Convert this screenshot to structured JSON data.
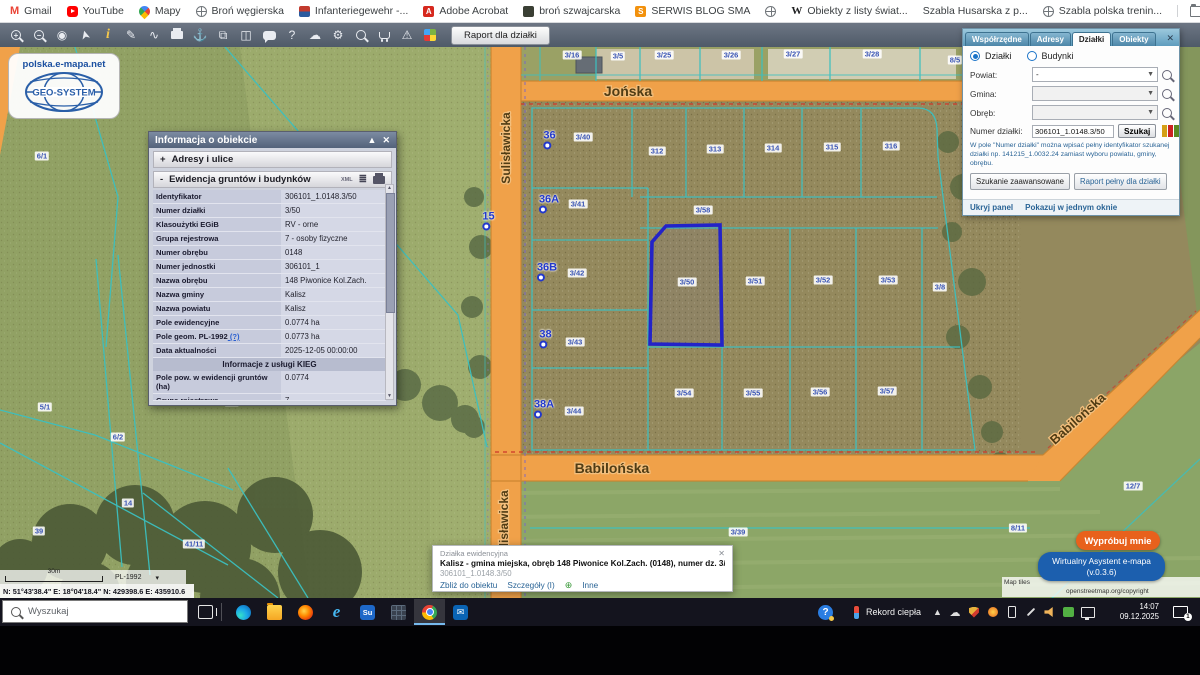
{
  "colors": {
    "road_orange": "#f0a149",
    "selection_blue": "#2323c8",
    "boundary_teal": "#3cc0c0",
    "parcel_label_blue": "#3a55b5",
    "assistant_orange": "#e8611c",
    "assistant_blue": "#1c5fae"
  },
  "bookmarks_bar": {
    "items": [
      {
        "icon": "gmail",
        "label": "Gmail"
      },
      {
        "icon": "youtube",
        "label": "YouTube"
      },
      {
        "icon": "maps-pin",
        "label": "Mapy"
      },
      {
        "icon": "globe",
        "label": "Broń węgierska"
      },
      {
        "icon": "flag",
        "label": "Infanteriegewehr -..."
      },
      {
        "icon": "acrobat",
        "label": "Adobe Acrobat"
      },
      {
        "icon": "dark-app",
        "label": "broń szwajcarska"
      },
      {
        "icon": "blog",
        "label": "SERWIS BLOG SMA"
      },
      {
        "icon": "globe",
        "label": ""
      },
      {
        "icon": "wikipedia",
        "label": "Obiekty z listy świat..."
      },
      {
        "icon": "none",
        "label": "Szabla Husarska z p..."
      },
      {
        "icon": "globe",
        "label": "Szabla polska trenin..."
      }
    ],
    "all_bookmarks": "Wszystkie zakładki"
  },
  "toolbar": {
    "tools": [
      {
        "name": "zoom-in"
      },
      {
        "name": "zoom-out"
      },
      {
        "name": "select-area"
      },
      {
        "name": "pointer"
      },
      {
        "name": "object-info"
      },
      {
        "name": "measure"
      },
      {
        "name": "link"
      },
      {
        "name": "print"
      },
      {
        "name": "download"
      },
      {
        "name": "copy-view"
      },
      {
        "name": "layout"
      },
      {
        "name": "comment"
      },
      {
        "name": "help"
      },
      {
        "name": "cloud-upload"
      },
      {
        "name": "settings"
      },
      {
        "name": "search-advanced"
      },
      {
        "name": "cart"
      },
      {
        "name": "warnings"
      },
      {
        "name": "legend"
      }
    ],
    "report_button": "Raport dla działki"
  },
  "map": {
    "logo": {
      "url_text": "polska.e-mapa.net",
      "brand": "GEO-SYSTEM"
    },
    "streets": {
      "jonska": "Jońska",
      "babilonska": "Babilońska",
      "babilonska_diag": "Babilońska",
      "sulislawicka": "Sulisławicka",
      "sulislawicka2": "Sulisławicka"
    },
    "selected_parcel": "3/50",
    "parcel_labels": [
      {
        "t": "3/16",
        "x": 572,
        "y": 8
      },
      {
        "t": "3/5",
        "x": 618,
        "y": 9
      },
      {
        "t": "3/25",
        "x": 664,
        "y": 8
      },
      {
        "t": "3/26",
        "x": 731,
        "y": 8
      },
      {
        "t": "3/27",
        "x": 793,
        "y": 7
      },
      {
        "t": "3/28",
        "x": 872,
        "y": 7
      },
      {
        "t": "8/5",
        "x": 955,
        "y": 13
      },
      {
        "t": "3/40",
        "x": 583,
        "y": 90
      },
      {
        "t": "312",
        "x": 657,
        "y": 104
      },
      {
        "t": "313",
        "x": 715,
        "y": 102
      },
      {
        "t": "314",
        "x": 773,
        "y": 101
      },
      {
        "t": "315",
        "x": 832,
        "y": 100
      },
      {
        "t": "316",
        "x": 891,
        "y": 99
      },
      {
        "t": "3/41",
        "x": 578,
        "y": 157
      },
      {
        "t": "3/58",
        "x": 703,
        "y": 163
      },
      {
        "t": "3/42",
        "x": 577,
        "y": 226
      },
      {
        "t": "3/50",
        "x": 687,
        "y": 235
      },
      {
        "t": "3/51",
        "x": 755,
        "y": 234
      },
      {
        "t": "3/52",
        "x": 823,
        "y": 233
      },
      {
        "t": "3/53",
        "x": 888,
        "y": 233
      },
      {
        "t": "3/8",
        "x": 940,
        "y": 240
      },
      {
        "t": "3/43",
        "x": 575,
        "y": 295
      },
      {
        "t": "3/54",
        "x": 684,
        "y": 346
      },
      {
        "t": "3/55",
        "x": 753,
        "y": 346
      },
      {
        "t": "3/56",
        "x": 820,
        "y": 345
      },
      {
        "t": "3/57",
        "x": 887,
        "y": 344
      },
      {
        "t": "3/44",
        "x": 574,
        "y": 364
      },
      {
        "t": "3/39",
        "x": 738,
        "y": 485
      },
      {
        "t": "12/5",
        "x": 1128,
        "y": 90
      },
      {
        "t": "12/7",
        "x": 1133,
        "y": 439
      },
      {
        "t": "8/11",
        "x": 1018,
        "y": 481
      },
      {
        "t": "6/1",
        "x": 42,
        "y": 109
      },
      {
        "t": "5/1",
        "x": 45,
        "y": 360
      },
      {
        "t": "6/2",
        "x": 118,
        "y": 390
      },
      {
        "t": "7/2",
        "x": 232,
        "y": 355
      },
      {
        "t": "14",
        "x": 128,
        "y": 456
      },
      {
        "t": "39",
        "x": 39,
        "y": 484
      },
      {
        "t": "41/11",
        "x": 194,
        "y": 497
      }
    ],
    "address_points": [
      {
        "t": "36",
        "x": 547,
        "y": 92
      },
      {
        "t": "36A",
        "x": 545,
        "y": 156
      },
      {
        "t": "36B",
        "x": 543,
        "y": 224
      },
      {
        "t": "38",
        "x": 543,
        "y": 291
      },
      {
        "t": "38A",
        "x": 540,
        "y": 361
      },
      {
        "t": "15",
        "x": 486,
        "y": 173
      }
    ]
  },
  "info_popup": {
    "title": "Informacja o obiekcie",
    "sections": {
      "addresses": "Adresy i ulice",
      "egib": "Ewidencja gruntów i budynków"
    },
    "xml_label": "XML",
    "rows": [
      {
        "l": "Identyfikator",
        "v": "306101_1.0148.3/50"
      },
      {
        "l": "Numer działki",
        "v": "3/50"
      },
      {
        "l": "Klasoużytki EGiB",
        "v": "RV - orne"
      },
      {
        "l": "Grupa rejestrowa",
        "v": "7 - osoby fizyczne"
      },
      {
        "l": "Numer obrębu",
        "v": "0148"
      },
      {
        "l": "Numer jednostki",
        "v": "306101_1"
      },
      {
        "l": "Nazwa obrębu",
        "v": "148 Piwonice Kol.Zach."
      },
      {
        "l": "Nazwa gminy",
        "v": "Kalisz"
      },
      {
        "l": "Nazwa powiatu",
        "v": "Kalisz"
      },
      {
        "l": "Pole ewidencyjne",
        "v": "0.0774 ha"
      },
      {
        "l": "Pole geom. PL-1992",
        "link": "(?)",
        "v": "0.0773 ha"
      },
      {
        "l": "Data aktualności",
        "v": "2025-12-05 00:00:00"
      },
      {
        "section": "Informacje z usługi KIEG"
      },
      {
        "l": "Pole pow. w ewidencji gruntów (ha)",
        "v": "0.0774"
      },
      {
        "l": "Grupa rejestrowa",
        "v": "7",
        "clipped": true
      }
    ]
  },
  "right_panel": {
    "tabs": [
      "Współrzędne",
      "Adresy",
      "Działki",
      "Obiekty"
    ],
    "active_tab": "Działki",
    "radio_dzialki": "Działki",
    "radio_budynki": "Budynki",
    "fields": {
      "powiat_label": "Powiat:",
      "powiat_value": "-",
      "gmina_label": "Gmina:",
      "gmina_value": "",
      "obreb_label": "Obręb:",
      "obreb_value": "",
      "numer_label": "Numer działki:",
      "numer_value": "306101_1.0148.3/50"
    },
    "szukaj_button": "Szukaj",
    "hint": "W pole \"Numer działki\" można wpisać pełny identyfikator szukanej działki np. 141215_1.0032.24 zamiast wyboru powiatu, gminy, obrębu.",
    "adv_button": "Szukanie zaawansowane",
    "report_button": "Raport pełny dla działki",
    "hide_panel": "Ukryj panel",
    "single_window": "Pokazuj w jednym oknie"
  },
  "bottom_popup": {
    "title": "Działka ewidencyjna",
    "main": "Kalisz - gmina miejska, obręb 148 Piwonice Kol.Zach. (0148), numer dz. 3/50",
    "id": "306101_1.0148.3/50",
    "links": [
      "Zbliż do obiektu",
      "Szczegóły (I)",
      "Inne"
    ]
  },
  "scale_bar": {
    "distance": "30m",
    "crs": "PL-1992",
    "coordinates": "N: 51°43'38.4\"  E: 18°04'18.4\"   N: 429398.6   E: 435910.6"
  },
  "assistant": {
    "try_me": "Wypróbuj mnie",
    "name": "Wirtualny Asystent e-mapa",
    "version": "(v.0.3.6)"
  },
  "attribution": {
    "line1": "Map tiles",
    "line2": "openstreetmap.org/copyright"
  },
  "taskbar": {
    "search_placeholder": "Wyszukaj",
    "apps": [
      {
        "name": "edge"
      },
      {
        "name": "explorer"
      },
      {
        "name": "firefox"
      },
      {
        "name": "ie"
      },
      {
        "name": "sumatra"
      },
      {
        "name": "grid"
      },
      {
        "name": "chrome",
        "active": true
      },
      {
        "name": "outlook"
      }
    ],
    "tray": [
      {
        "name": "onedrive"
      },
      {
        "name": "defender"
      },
      {
        "name": "updates"
      },
      {
        "name": "phone"
      },
      {
        "name": "pen"
      },
      {
        "name": "volume"
      },
      {
        "name": "teams"
      },
      {
        "name": "network"
      }
    ],
    "weather_text": "Rekord ciepła",
    "time": "14:07",
    "date": "09.12.2025",
    "notification_count": "1"
  }
}
